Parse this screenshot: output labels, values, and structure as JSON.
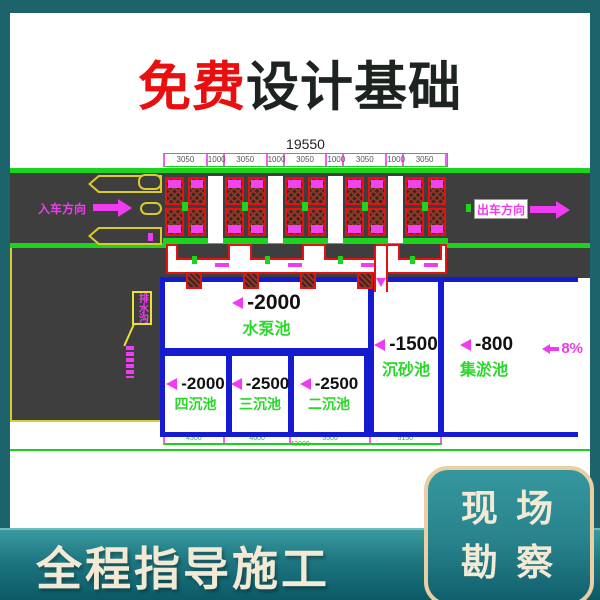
{
  "colors": {
    "frame_teal": "#1c636c",
    "title_red": "#e90f0f",
    "title_dark": "#1d2420",
    "cad_green": "#1bd41b",
    "cad_magenta": "#f03cf0",
    "cad_blue": "#141bd0",
    "cad_yellow": "#d9cb2b",
    "cad_red": "#e31313",
    "road_gray": "#3e3e3e",
    "cream_text": "#f3e9d4",
    "cream_border": "#e9cfa3"
  },
  "title": {
    "highlight": "免费",
    "rest": "设计基础"
  },
  "drawing": {
    "top_total": "19550",
    "top_dims": [
      "3050",
      "1000",
      "3050",
      "1000",
      "3050",
      "1000",
      "3050",
      "1000",
      "3050"
    ],
    "entry_label": "入车方向",
    "exit_label": "出车方向",
    "leader_label": "排水沟",
    "pools": {
      "pump": {
        "depth": "-2000",
        "name": "水泵池"
      },
      "fourth": {
        "depth": "-2000",
        "name": "四沉池"
      },
      "third": {
        "depth": "-2500",
        "name": "三沉池"
      },
      "second": {
        "depth": "-2500",
        "name": "二沉池"
      },
      "sand": {
        "depth": "-1500",
        "name": "沉砂池"
      },
      "sludge": {
        "depth": "-800",
        "name": "集淤池"
      },
      "slope_percent": "8%"
    },
    "bottom_dims": [
      "4300",
      "4600",
      "5500",
      "5150"
    ],
    "bottom_total": "43000"
  },
  "footer": {
    "slogan": "全程指导施工",
    "badge_line1": "现 场",
    "badge_line2": "勘 察"
  }
}
